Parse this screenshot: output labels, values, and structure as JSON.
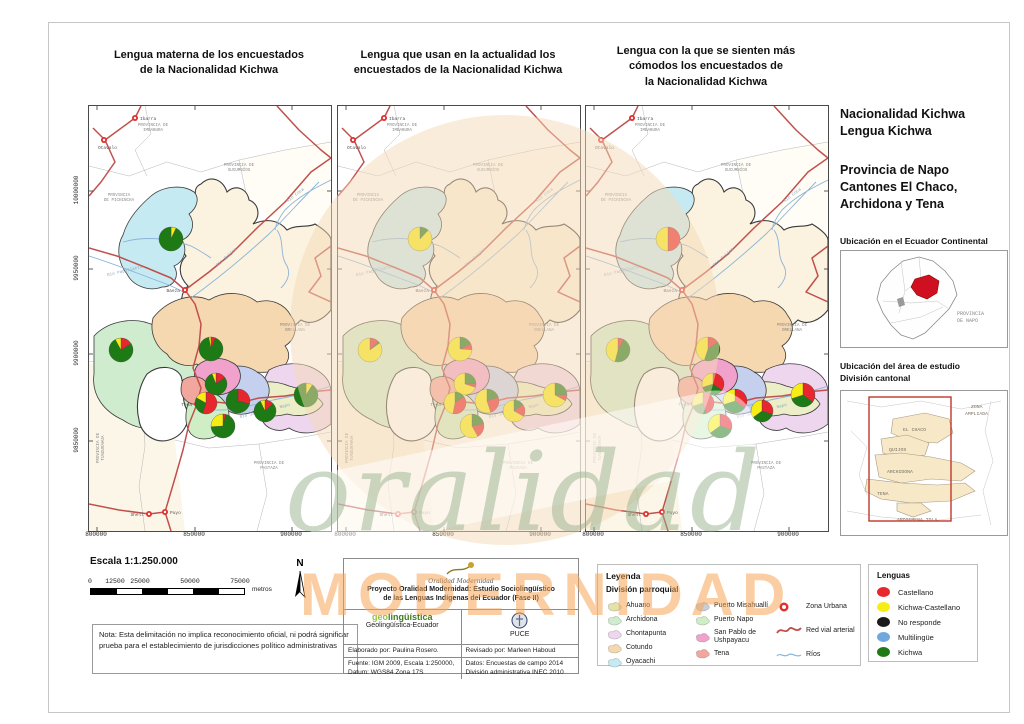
{
  "maps": [
    {
      "title": "Lengua materna de los  encuestados\nde la Nacionalidad Kichwa",
      "pies": {
        "oyacachi": [
          [
            "kichwa_castellano",
            7
          ],
          [
            "kichwa",
            93
          ]
        ],
        "archidona": [
          [
            "castellano",
            16
          ],
          [
            "kichwa",
            76
          ],
          [
            "kichwa_castellano",
            8
          ]
        ],
        "cotundo": [
          [
            "castellano",
            6
          ],
          [
            "kichwa",
            91
          ],
          [
            "kichwa_castellano",
            3
          ]
        ],
        "san_pablo": [
          [
            "castellano",
            15
          ],
          [
            "kichwa",
            79
          ],
          [
            "kichwa_castellano",
            6
          ]
        ],
        "tena": [
          [
            "castellano",
            55
          ],
          [
            "kichwa",
            28
          ],
          [
            "kichwa_castellano",
            17
          ]
        ],
        "puerto_misahualli": [
          [
            "castellano",
            29
          ],
          [
            "kichwa",
            71
          ]
        ],
        "ahuano": [
          [
            "castellano",
            13
          ],
          [
            "kichwa",
            80
          ],
          [
            "kichwa_castellano",
            7
          ]
        ],
        "chontapunta": [
          [
            "kichwa_castellano",
            9
          ],
          [
            "kichwa",
            91
          ]
        ],
        "puerto_napo": [
          [
            "castellano",
            4
          ],
          [
            "kichwa",
            70
          ],
          [
            "kichwa_castellano",
            26
          ]
        ]
      }
    },
    {
      "title": "Lengua que usan en la actualidad los\nencuestados de la Nacionalidad Kichwa",
      "pies": {
        "oyacachi": [
          [
            "kichwa",
            12
          ],
          [
            "kichwa_castellano",
            88
          ]
        ],
        "archidona": [
          [
            "castellano",
            12
          ],
          [
            "kichwa",
            3
          ],
          [
            "kichwa_castellano",
            85
          ]
        ],
        "cotundo": [
          [
            "kichwa",
            18
          ],
          [
            "castellano",
            8
          ],
          [
            "kichwa_castellano",
            74
          ]
        ],
        "san_pablo": [
          [
            "kichwa",
            25
          ],
          [
            "castellano",
            5
          ],
          [
            "kichwa_castellano",
            70
          ]
        ],
        "tena": [
          [
            "kichwa",
            15
          ],
          [
            "castellano",
            38
          ],
          [
            "kichwa_castellano",
            47
          ]
        ],
        "puerto_misahualli": [
          [
            "kichwa",
            20
          ],
          [
            "castellano",
            25
          ],
          [
            "kichwa_castellano",
            55
          ]
        ],
        "ahuano": [
          [
            "kichwa",
            15
          ],
          [
            "castellano",
            18
          ],
          [
            "kichwa_castellano",
            67
          ]
        ],
        "chontapunta": [
          [
            "kichwa",
            25
          ],
          [
            "castellano",
            8
          ],
          [
            "kichwa_castellano",
            67
          ]
        ],
        "puerto_napo": [
          [
            "kichwa",
            22
          ],
          [
            "castellano",
            20
          ],
          [
            "kichwa_castellano",
            58
          ]
        ]
      }
    },
    {
      "title": "Lengua con la que se sienten más\ncómodos los encuestados de\nla Nacionalidad Kichwa",
      "pies": {
        "oyacachi": [
          [
            "castellano",
            50
          ],
          [
            "kichwa_castellano",
            50
          ]
        ],
        "archidona": [
          [
            "castellano",
            8
          ],
          [
            "kichwa",
            46
          ],
          [
            "kichwa_castellano",
            46
          ]
        ],
        "cotundo": [
          [
            "castellano",
            15
          ],
          [
            "kichwa",
            40
          ],
          [
            "kichwa_castellano",
            45
          ]
        ],
        "san_pablo": [
          [
            "castellano",
            35
          ],
          [
            "kichwa",
            35
          ],
          [
            "kichwa_castellano",
            30
          ]
        ],
        "tena": [
          [
            "castellano",
            45
          ],
          [
            "kichwa",
            25
          ],
          [
            "kichwa_castellano",
            30
          ]
        ],
        "puerto_misahualli": [
          [
            "castellano",
            35
          ],
          [
            "kichwa",
            35
          ],
          [
            "kichwa_castellano",
            30
          ]
        ],
        "ahuano": [
          [
            "castellano",
            30
          ],
          [
            "kichwa",
            35
          ],
          [
            "kichwa_castellano",
            35
          ]
        ],
        "chontapunta": [
          [
            "castellano",
            35
          ],
          [
            "kichwa",
            35
          ],
          [
            "kichwa_castellano",
            30
          ]
        ],
        "puerto_napo": [
          [
            "castellano",
            30
          ],
          [
            "kichwa",
            35
          ],
          [
            "kichwa_castellano",
            35
          ]
        ]
      }
    }
  ],
  "map_common": {
    "x_ticks": [
      "800000",
      "850000",
      "900000"
    ],
    "y_ticks": [
      "10000000",
      "9950000",
      "9900000",
      "9850000"
    ],
    "provinces": [
      "PROVINCIA DE\nIMBABURA",
      "PROVINCIA DE\nSUCUMBÍOS",
      "PROVINCIA\nDE PICHINCHA",
      "PROVINCIA DE\nORELLANA",
      "PROVINCIA DE\nPASTAZA",
      "PROVINCIA DE\nTUNGURAHUA"
    ],
    "cities": [
      "Ibarra",
      "Otavalo",
      "Baeza",
      "Tena",
      "Puyo",
      "Shell"
    ],
    "rivers": [
      "Río Coca",
      "Río Quijos",
      "Río Papallacta",
      "Río Jatunyacu - Napo"
    ]
  },
  "sidebar": {
    "title1": "Nacionalidad Kichwa\nLengua Kichwa",
    "title2": "Provincia de Napo\nCantones El Chaco,\nArchidona y Tena",
    "inset1_title": "Ubicación en el Ecuador Continental",
    "inset1_label_l1": "PROVINCIA",
    "inset1_label_l2": "DE NAPO",
    "inset2_title": "Ubicación del área de estudio\nDivisión cantonal",
    "inset2_zona_l1": "ZONA",
    "inset2_zona_l2": "AMPLIADA",
    "inset2_elchaco": "EL CHACO",
    "inset2_quijos": "QUIJOS",
    "inset2_archidona": "ARCHIDONA",
    "inset2_tena": "TENA",
    "inset2_arosemena": "AROSEMENA TOLA"
  },
  "scale": {
    "title": "Escala 1:1.250.000",
    "ticks": [
      "0",
      "12500",
      "25000",
      "50000",
      "75000"
    ],
    "unit": "metros",
    "north": "N"
  },
  "note": "Nota: Esta delimitación no implica reconocimiento oficial, ni podrá significar prueba para el establecimiento de jurisdicciones político administrativas",
  "credits": {
    "logo_script": "Oralidad Modernidad",
    "project": "Proyecto Oralidad Modernidad: Estudio Sociolingüístico\nde las Lenguas Indígenas del Ecuador  (Fase II)",
    "logo_geo": "geo",
    "logo_geo_rest": "lingüística",
    "org_left": "Geolingüística-Ecuador",
    "org_right": "PUCE",
    "elaborado": "Elaborado por: Paulina Rosero.",
    "revisado": "Revisado por: Marleen Haboud",
    "fuente": "Fuente: IGM 2009, Escala 1:250000,\nDatum: WGS84 Zona 17S",
    "datos": "Datos: Encuestas de campo 2014\nDivisión administrativa INEC 2010"
  },
  "legend": {
    "title": "Leyenda",
    "subtitle": "División parroquial",
    "parishes_col1": [
      {
        "id": "ahuano",
        "label": "Ahuano",
        "color": "#e5e2a9"
      },
      {
        "id": "archidona",
        "label": "Archidona",
        "color": "#cfeccf"
      },
      {
        "id": "chontapunta",
        "label": "Chontapunta",
        "color": "#eed6ee"
      },
      {
        "id": "cotundo",
        "label": "Cotundo",
        "color": "#f6d8b0"
      },
      {
        "id": "oyacachi",
        "label": "Oyacachi",
        "color": "#c6eaf2"
      }
    ],
    "parishes_col2": [
      {
        "id": "puerto_misahualli",
        "label": "Puerto Misahuallí",
        "color": "#c6cfdf"
      },
      {
        "id": "puerto_napo",
        "label": "Puerto Napo",
        "color": "#cfeec6"
      },
      {
        "id": "san_pablo",
        "label": "San Pablo de\nUshpayacu",
        "color": "#f0a2cc"
      },
      {
        "id": "tena",
        "label": "Tena",
        "color": "#f2a79e"
      }
    ],
    "symbols": [
      {
        "id": "zona_urbana",
        "label": "Zona Urbana"
      },
      {
        "id": "red_vial",
        "label": "Red vial arterial"
      },
      {
        "id": "rios",
        "label": "Ríos"
      }
    ]
  },
  "lenguas": {
    "title": "Lenguas",
    "items": [
      {
        "id": "castellano",
        "label": "Castellano",
        "color": "#e8262d"
      },
      {
        "id": "kichwa_castellano",
        "label": "Kichwa-Castellano",
        "color": "#f7ec13"
      },
      {
        "id": "no_responde",
        "label": "No responde",
        "color": "#1b1b1b"
      },
      {
        "id": "multilingue",
        "label": "Multilingüe",
        "color": "#6fa8dc"
      },
      {
        "id": "kichwa",
        "label": "Kichwa",
        "color": "#1e7a14"
      }
    ]
  },
  "watermark": {
    "script_text": "oralidad",
    "block_text": "MODERNIDAD"
  }
}
